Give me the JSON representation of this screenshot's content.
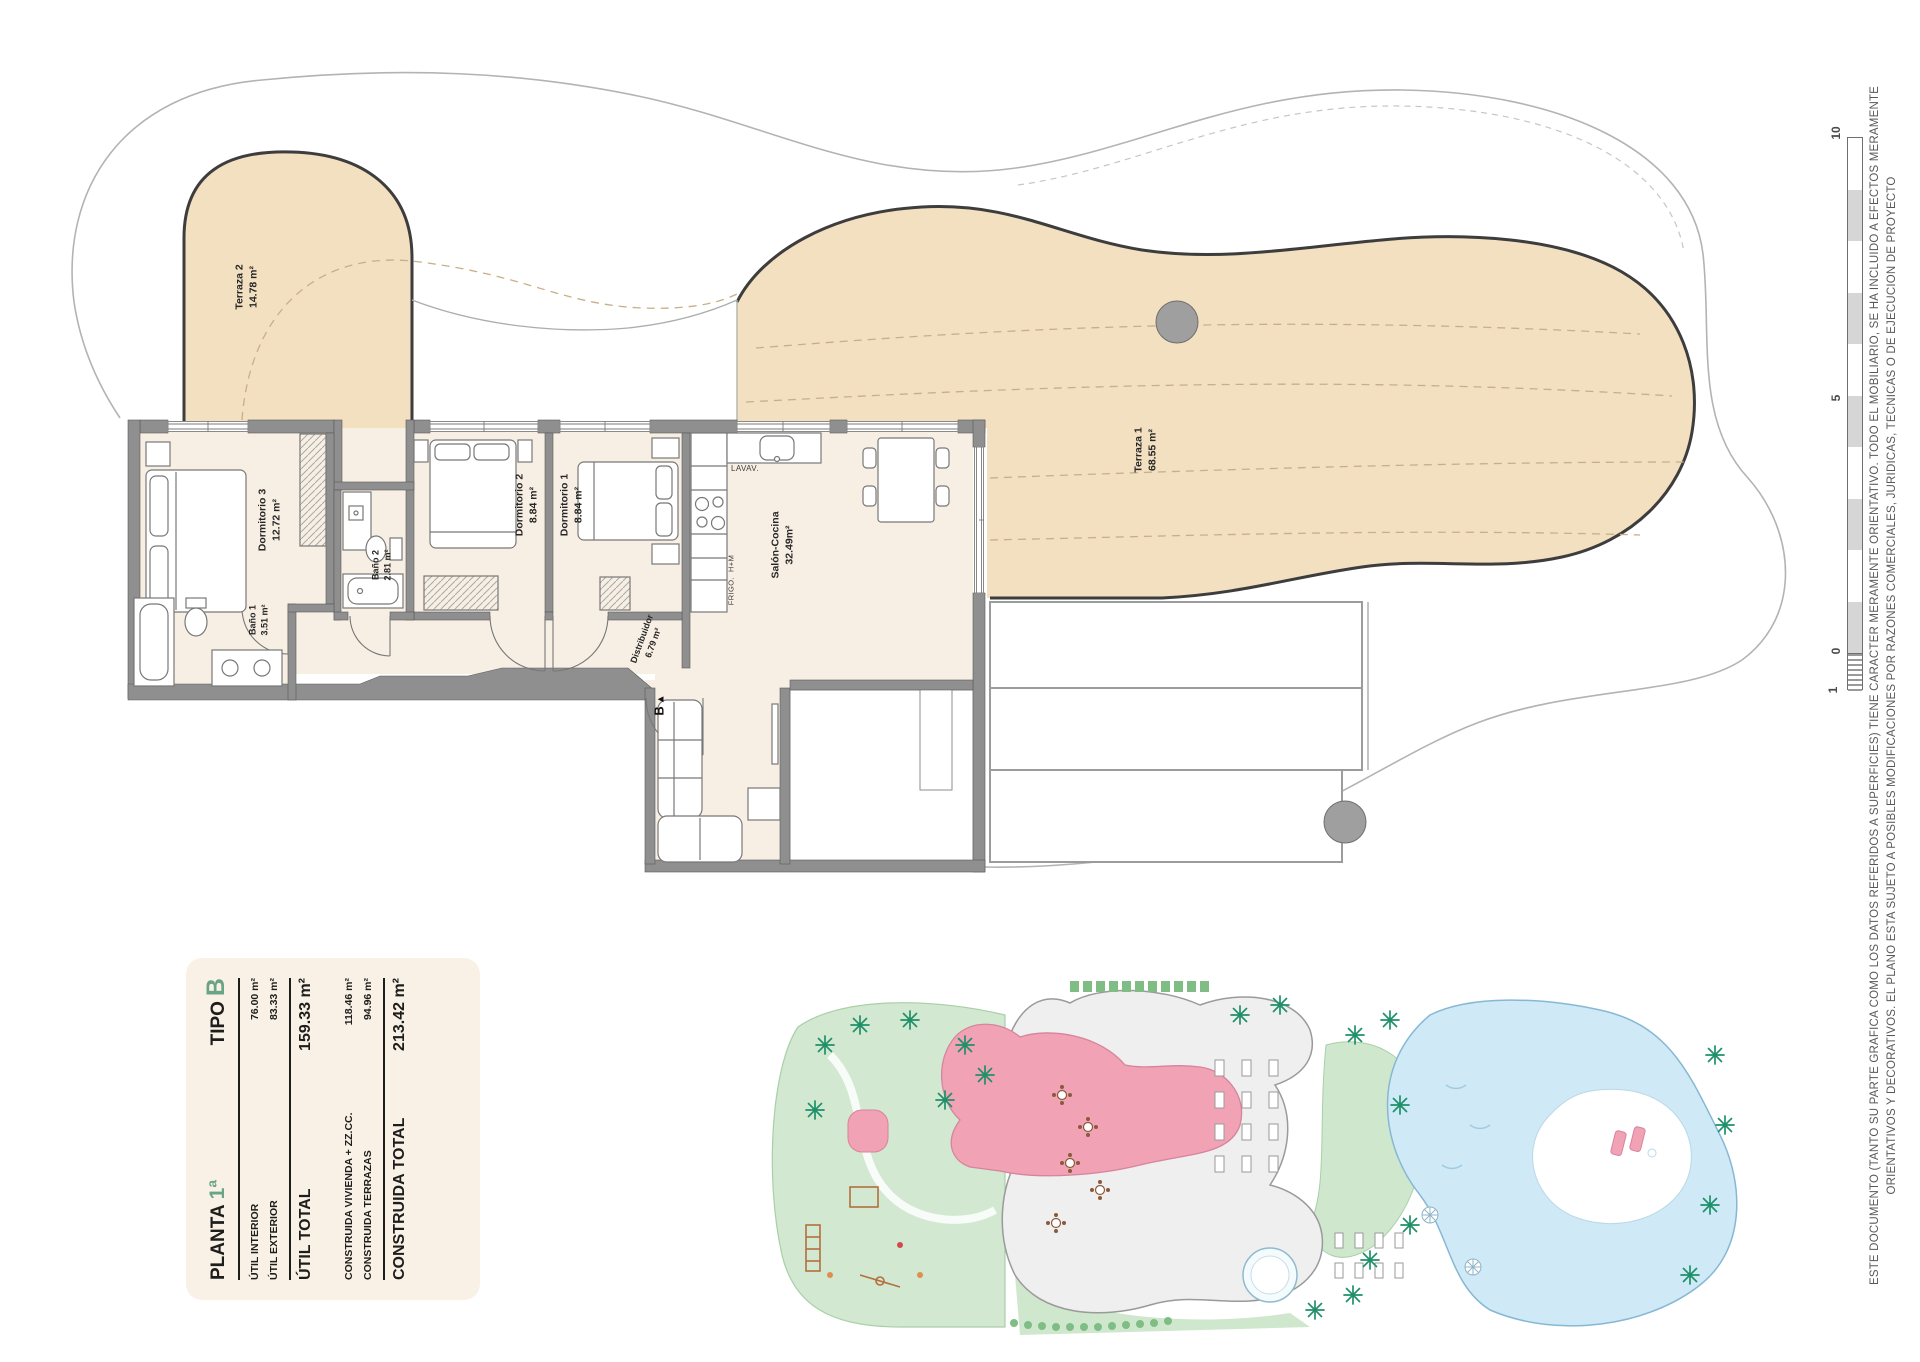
{
  "panel": {
    "title_left": "PLANTA",
    "title_left_accent": "1ª",
    "title_right": "TIPO",
    "title_right_accent": "B",
    "util_interior": {
      "label": "ÚTIL INTERIOR",
      "value": "76.00 m²"
    },
    "util_exterior": {
      "label": "ÚTIL EXTERIOR",
      "value": "83.33 m²"
    },
    "util_total": {
      "label": "ÚTIL TOTAL",
      "value": "159.33 m²"
    },
    "construida_vivienda": {
      "label": "CONSTRUIDA VIVIENDA + ZZ.CC.",
      "value": "118.46 m²"
    },
    "construida_terrazas": {
      "label": "CONSTRUIDA TERRAZAS",
      "value": "94.96 m²"
    },
    "construida_total": {
      "label": "CONSTRUIDA TOTAL",
      "value": "213.42 m²"
    }
  },
  "rooms": {
    "terraza2": {
      "name": "Terraza 2",
      "area": "14.78 m²"
    },
    "dormitorio3": {
      "name": "Dormitorio 3",
      "area": "12.72 m²"
    },
    "bano1": {
      "name": "Baño 1",
      "area": "3.51 m²"
    },
    "bano2": {
      "name": "Baño 2",
      "area": "2.81 m²"
    },
    "dormitorio2": {
      "name": "Dormitorio 2",
      "area": "8.84 m²"
    },
    "dormitorio1": {
      "name": "Dormitorio 1",
      "area": "8.84 m²"
    },
    "salon": {
      "name": "Salón-Cocina",
      "area": "32.49m²"
    },
    "distribuidor": {
      "name": "Distribuidor",
      "area": "6.79 m²"
    },
    "terraza1": {
      "name": "Terraza 1",
      "area": "68.55 m²"
    }
  },
  "fixtures": {
    "lavav": "LAVAV.",
    "frigo": "FRIGO.",
    "hm": "H+M",
    "entry_marker": "B",
    "entry_arrow": "▲"
  },
  "scale_bar": {
    "ticks": [
      "10",
      "5",
      "0",
      "1"
    ]
  },
  "disclaimer": {
    "line1": "ESTE DOCUMENTO (TANTO SU PARTE GRAFICA COMO LOS DATOS REFERIDOS A SUPERFICIES) TIENE CARACTER MERAMENTE ORIENTATIVO. TODO EL MOBILIARIO, SE HA INCLUIDO A EFECTOS MERAMENTE",
    "line2": "ORIENTATIVOS Y DECORATIVOS. EL PLANO ESTA SUJETO A POSIBLES MODIFICACIONES POR RAZONES COMERCIALES, JURIDICAS, TECNICAS O DE EJECUCION DE PROYECTO"
  },
  "colors": {
    "accent_green": "#6aa487",
    "terrace_tan": "#f2e0c1",
    "room_cream": "#f8efe4",
    "wall_gray": "#8f8f8f",
    "site_pink": "#f1a2b5",
    "site_green": "#cfe7cd",
    "pool_blue": "#cfe9f6"
  }
}
